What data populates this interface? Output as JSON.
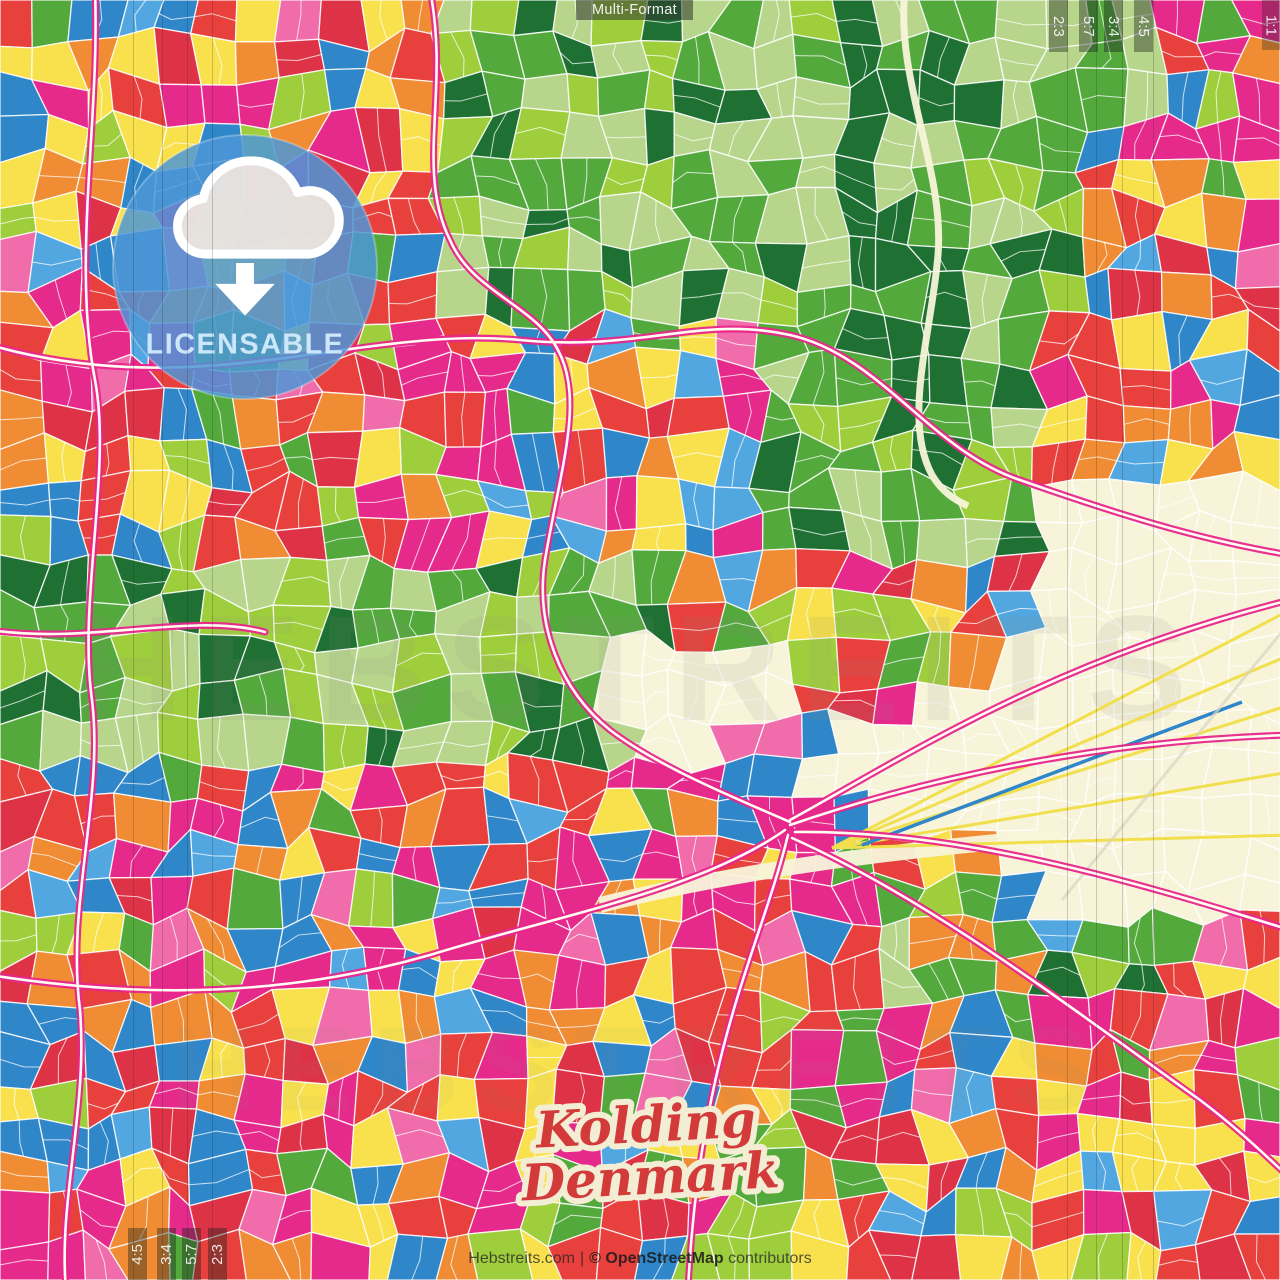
{
  "header": {
    "format_label": "Multi-Format"
  },
  "badge": {
    "label": "LICENSABLE",
    "icon": "cloud-download-icon",
    "circle_color": "#4e97d6",
    "text_color": "#cde7fa"
  },
  "title": {
    "city": "Kolding",
    "country": "Denmark",
    "fill": "#d23b3a",
    "outline": "#f3edd3"
  },
  "footer": {
    "site": "Hebstreits.com",
    "separator": "|",
    "attribution_bold": "© OpenStreetMap",
    "attribution_rest": "contributors"
  },
  "watermark": "HEBSTREITS",
  "crop_marks": {
    "corner_label": "1:1",
    "top_right": [
      {
        "label": "2:3",
        "x": 1049
      },
      {
        "label": "5:7",
        "x": 1079
      },
      {
        "label": "3:4",
        "x": 1104
      },
      {
        "label": "4:5",
        "x": 1134
      }
    ],
    "bottom_left": [
      {
        "label": "4:5",
        "x": 128
      },
      {
        "label": "3:4",
        "x": 157
      },
      {
        "label": "5:7",
        "x": 182
      },
      {
        "label": "2:3",
        "x": 208
      }
    ]
  },
  "map_style": {
    "palette": {
      "red": "#e8403d",
      "crimson": "#de3347",
      "blue": "#2f86c9",
      "azure": "#52a7e0",
      "yellow": "#f9e14d",
      "orange": "#f08c33",
      "magenta": "#e62a8b",
      "pink": "#f06cab",
      "green_mid": "#53a93c",
      "lime": "#9fce3c",
      "green_pale": "#b7d68b",
      "green_dark": "#1f7033",
      "cream": "#f8f4da"
    },
    "road_accent": "#e8268c",
    "road_core": "#fffdf2",
    "street_color": "#ffffff",
    "rail_yellow": "#f2df4e"
  }
}
